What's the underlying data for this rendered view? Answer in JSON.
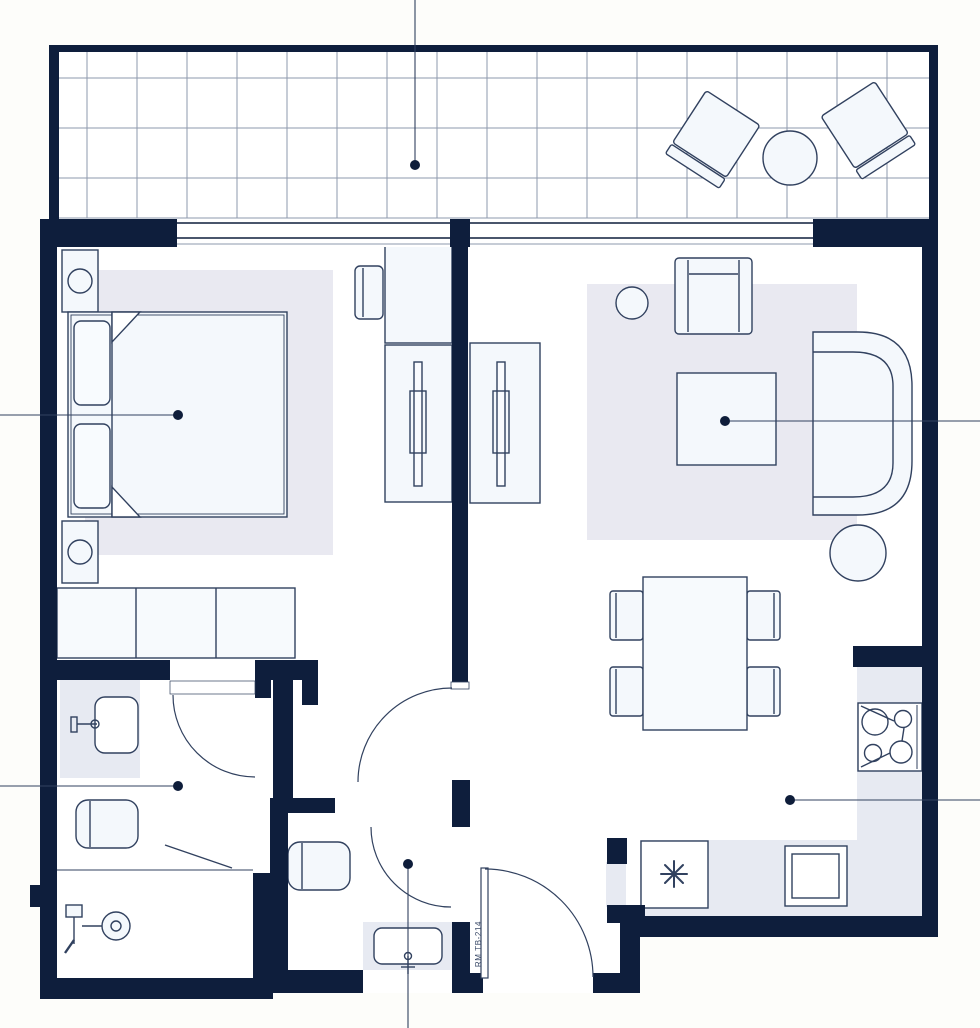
{
  "plan": {
    "label": "RM TB-214",
    "kind": "hotel-room-floor-plan",
    "rooms": [
      {
        "id": "balcony",
        "features": [
          "tiled-floor",
          "patio-chair",
          "patio-chair",
          "patio-round-table",
          "leader-dot"
        ]
      },
      {
        "id": "bedroom",
        "features": [
          "double-bed",
          "pillow",
          "pillow",
          "nightstand-with-lamp",
          "nightstand-with-lamp",
          "rug",
          "desk",
          "desk-chair",
          "tv-cabinet",
          "wardrobe-3-door",
          "leader-dot"
        ]
      },
      {
        "id": "living-room",
        "features": [
          "sofa",
          "armchair",
          "coffee-table",
          "side-table",
          "round-table",
          "rug",
          "tv-cabinet",
          "dining-table",
          "dining-chair-x4",
          "leader-dot"
        ]
      },
      {
        "id": "bathroom",
        "features": [
          "vanity-sink",
          "faucet",
          "toilet",
          "walk-in-shower",
          "shower-head",
          "shower-drain",
          "leader-dot"
        ]
      },
      {
        "id": "wc",
        "features": [
          "toilet",
          "vanity-sink",
          "faucet",
          "leader-dot"
        ]
      },
      {
        "id": "kitchen",
        "features": [
          "counter",
          "cooktop-4-burner",
          "oven",
          "asterisk-appliance",
          "leader-dot"
        ]
      },
      {
        "id": "entry",
        "features": [
          "entry-door"
        ]
      }
    ]
  },
  "colors": {
    "wall": "#0e1e3c",
    "outline": "#31415f",
    "furn": "#f4f8fc",
    "floor": "#ffffff",
    "bg": "#fdfdfa",
    "rug": "#e9e9f1",
    "counter": "#e7eaf2",
    "grid": "#8e98ac",
    "dot": "#0e1d3a",
    "label": "#3a4a68"
  }
}
